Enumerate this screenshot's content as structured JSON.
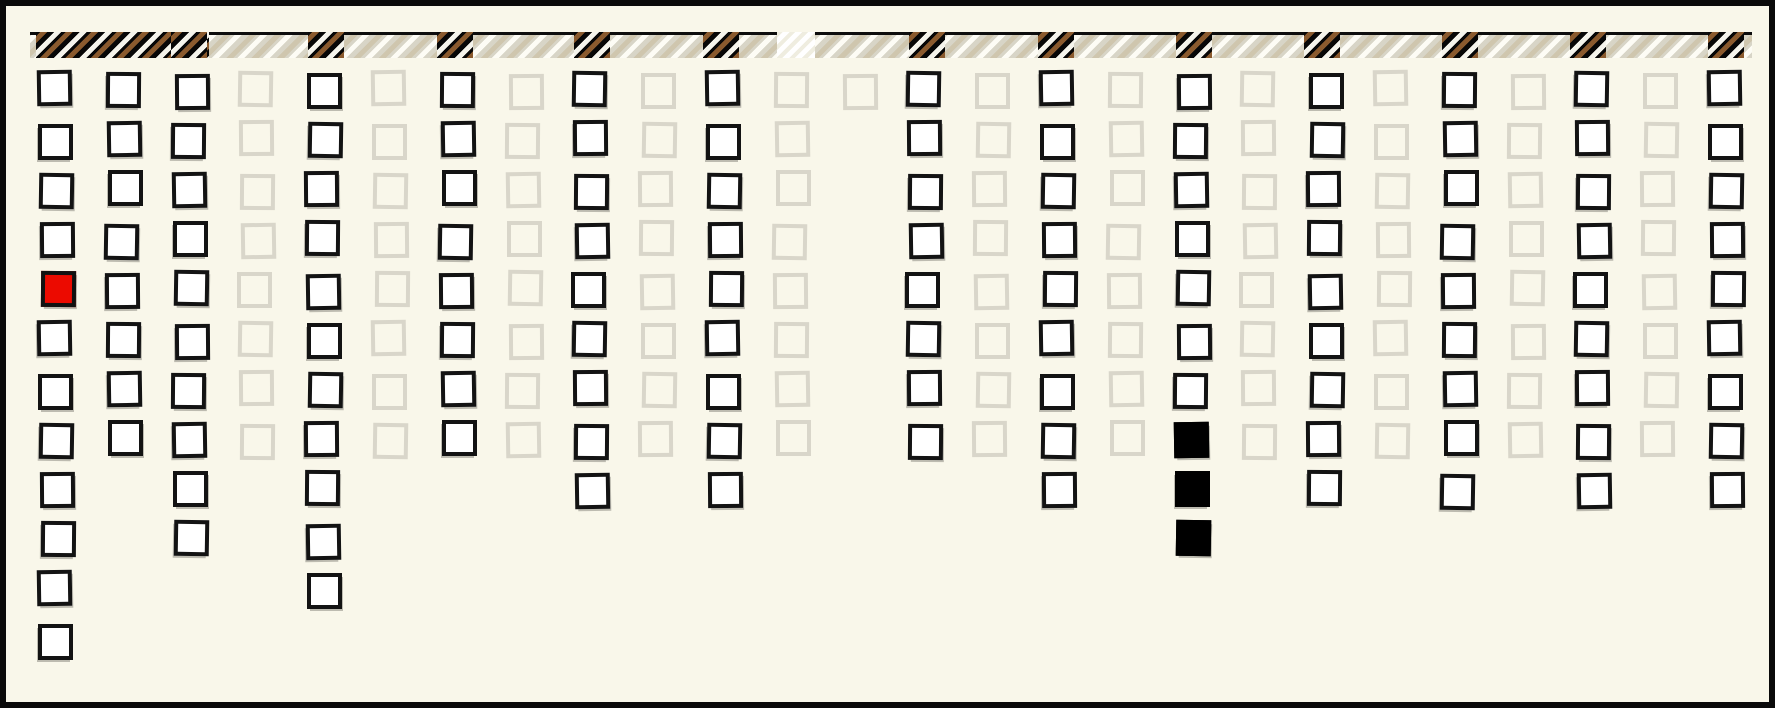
{
  "palette": {
    "page_background": "#f9f7ea",
    "frame_border": "#0a0a0a",
    "dark_cell_border": "#131313",
    "dark_cell_fill": "#ffffff",
    "light_cell_border": "#d9d6ca",
    "red_cell_fill": "#ec0a00",
    "black_cell_fill": "#000000",
    "header_light_bg": "#d8d5c7",
    "header_dark_bg": "#070707",
    "header_bright_bg": "#efede0",
    "header_stripe_brown": "#8a5a2e",
    "header_stripe_white": "#fdfcf5",
    "header_stripe_tan": "#cfc6ae"
  },
  "chart_data": {
    "type": "heatmap",
    "title": "",
    "xlabel": "",
    "ylabel": "",
    "style": "hand-drawn sketch (xkcd-like) unit grid of squares below a hatched header strip",
    "n_columns": 26,
    "max_rows": 12,
    "legend": "none",
    "grid": "off",
    "header": [
      "dark_run",
      "dark_run",
      "dark_block",
      "light",
      "dark_block",
      "light",
      "dark_block",
      "light",
      "dark_block",
      "light",
      "dark_block",
      "light",
      "bright",
      "dark_block",
      "light",
      "dark_block",
      "light",
      "dark_block",
      "light",
      "dark_block",
      "light",
      "dark_block",
      "light",
      "dark_block",
      "light",
      "dark_block"
    ],
    "columns": [
      {
        "id": 1,
        "tone": "dark",
        "count": 12,
        "cells": [
          "white",
          "white",
          "white",
          "white",
          "red",
          "white",
          "white",
          "white",
          "white",
          "white",
          "white",
          "white"
        ]
      },
      {
        "id": 2,
        "tone": "dark",
        "count": 8,
        "cells": [
          "white",
          "white",
          "white",
          "white",
          "white",
          "white",
          "white",
          "white"
        ]
      },
      {
        "id": 3,
        "tone": "dark",
        "count": 10,
        "cells": [
          "white",
          "white",
          "white",
          "white",
          "white",
          "white",
          "white",
          "white",
          "white",
          "white"
        ]
      },
      {
        "id": 4,
        "tone": "light",
        "count": 8,
        "cells": [
          "outline",
          "outline",
          "outline",
          "outline",
          "outline",
          "outline",
          "outline",
          "outline"
        ]
      },
      {
        "id": 5,
        "tone": "dark",
        "count": 11,
        "cells": [
          "white",
          "white",
          "white",
          "white",
          "white",
          "white",
          "white",
          "white",
          "white",
          "white",
          "white"
        ]
      },
      {
        "id": 6,
        "tone": "light",
        "count": 8,
        "cells": [
          "outline",
          "outline",
          "outline",
          "outline",
          "outline",
          "outline",
          "outline",
          "outline"
        ]
      },
      {
        "id": 7,
        "tone": "dark",
        "count": 8,
        "cells": [
          "white",
          "white",
          "white",
          "white",
          "white",
          "white",
          "white",
          "white"
        ]
      },
      {
        "id": 8,
        "tone": "light",
        "count": 8,
        "cells": [
          "outline",
          "outline",
          "outline",
          "outline",
          "outline",
          "outline",
          "outline",
          "outline"
        ]
      },
      {
        "id": 9,
        "tone": "dark",
        "count": 9,
        "cells": [
          "white",
          "white",
          "white",
          "white",
          "white",
          "white",
          "white",
          "white",
          "white"
        ]
      },
      {
        "id": 10,
        "tone": "light",
        "count": 8,
        "cells": [
          "outline",
          "outline",
          "outline",
          "outline",
          "outline",
          "outline",
          "outline",
          "outline"
        ]
      },
      {
        "id": 11,
        "tone": "dark",
        "count": 9,
        "cells": [
          "white",
          "white",
          "white",
          "white",
          "white",
          "white",
          "white",
          "white",
          "white"
        ]
      },
      {
        "id": 12,
        "tone": "light",
        "count": 8,
        "cells": [
          "outline",
          "outline",
          "outline",
          "outline",
          "outline",
          "outline",
          "outline",
          "outline"
        ]
      },
      {
        "id": 13,
        "tone": "light",
        "count": 1,
        "cells": [
          "outline"
        ]
      },
      {
        "id": 14,
        "tone": "dark",
        "count": 8,
        "cells": [
          "white",
          "white",
          "white",
          "white",
          "white",
          "white",
          "white",
          "white"
        ]
      },
      {
        "id": 15,
        "tone": "light",
        "count": 8,
        "cells": [
          "outline",
          "outline",
          "outline",
          "outline",
          "outline",
          "outline",
          "outline",
          "outline"
        ]
      },
      {
        "id": 16,
        "tone": "dark",
        "count": 9,
        "cells": [
          "white",
          "white",
          "white",
          "white",
          "white",
          "white",
          "white",
          "white",
          "white"
        ]
      },
      {
        "id": 17,
        "tone": "light",
        "count": 8,
        "cells": [
          "outline",
          "outline",
          "outline",
          "outline",
          "outline",
          "outline",
          "outline",
          "outline"
        ]
      },
      {
        "id": 18,
        "tone": "dark",
        "count": 10,
        "cells": [
          "white",
          "white",
          "white",
          "white",
          "white",
          "white",
          "white",
          "black",
          "black",
          "black"
        ]
      },
      {
        "id": 19,
        "tone": "light",
        "count": 8,
        "cells": [
          "outline",
          "outline",
          "outline",
          "outline",
          "outline",
          "outline",
          "outline",
          "outline"
        ]
      },
      {
        "id": 20,
        "tone": "dark",
        "count": 9,
        "cells": [
          "white",
          "white",
          "white",
          "white",
          "white",
          "white",
          "white",
          "white",
          "white"
        ]
      },
      {
        "id": 21,
        "tone": "light",
        "count": 8,
        "cells": [
          "outline",
          "outline",
          "outline",
          "outline",
          "outline",
          "outline",
          "outline",
          "outline"
        ]
      },
      {
        "id": 22,
        "tone": "dark",
        "count": 9,
        "cells": [
          "white",
          "white",
          "white",
          "white",
          "white",
          "white",
          "white",
          "white",
          "white"
        ]
      },
      {
        "id": 23,
        "tone": "light",
        "count": 8,
        "cells": [
          "outline",
          "outline",
          "outline",
          "outline",
          "outline",
          "outline",
          "outline",
          "outline"
        ]
      },
      {
        "id": 24,
        "tone": "dark",
        "count": 9,
        "cells": [
          "white",
          "white",
          "white",
          "white",
          "white",
          "white",
          "white",
          "white",
          "white"
        ]
      },
      {
        "id": 25,
        "tone": "light",
        "count": 8,
        "cells": [
          "outline",
          "outline",
          "outline",
          "outline",
          "outline",
          "outline",
          "outline",
          "outline"
        ]
      },
      {
        "id": 26,
        "tone": "dark",
        "count": 9,
        "cells": [
          "white",
          "white",
          "white",
          "white",
          "white",
          "white",
          "white",
          "white",
          "white"
        ]
      }
    ],
    "special_cells": [
      {
        "column": 1,
        "row": 5,
        "fill": "red"
      },
      {
        "column": 18,
        "row": 8,
        "fill": "black"
      },
      {
        "column": 18,
        "row": 9,
        "fill": "black"
      },
      {
        "column": 18,
        "row": 10,
        "fill": "black"
      }
    ]
  },
  "render_hints": {
    "understroke_columns": [
      3,
      9,
      11,
      16,
      20,
      22,
      24,
      26
    ],
    "dark_run_width": 173,
    "bright_patch_left": 747
  }
}
